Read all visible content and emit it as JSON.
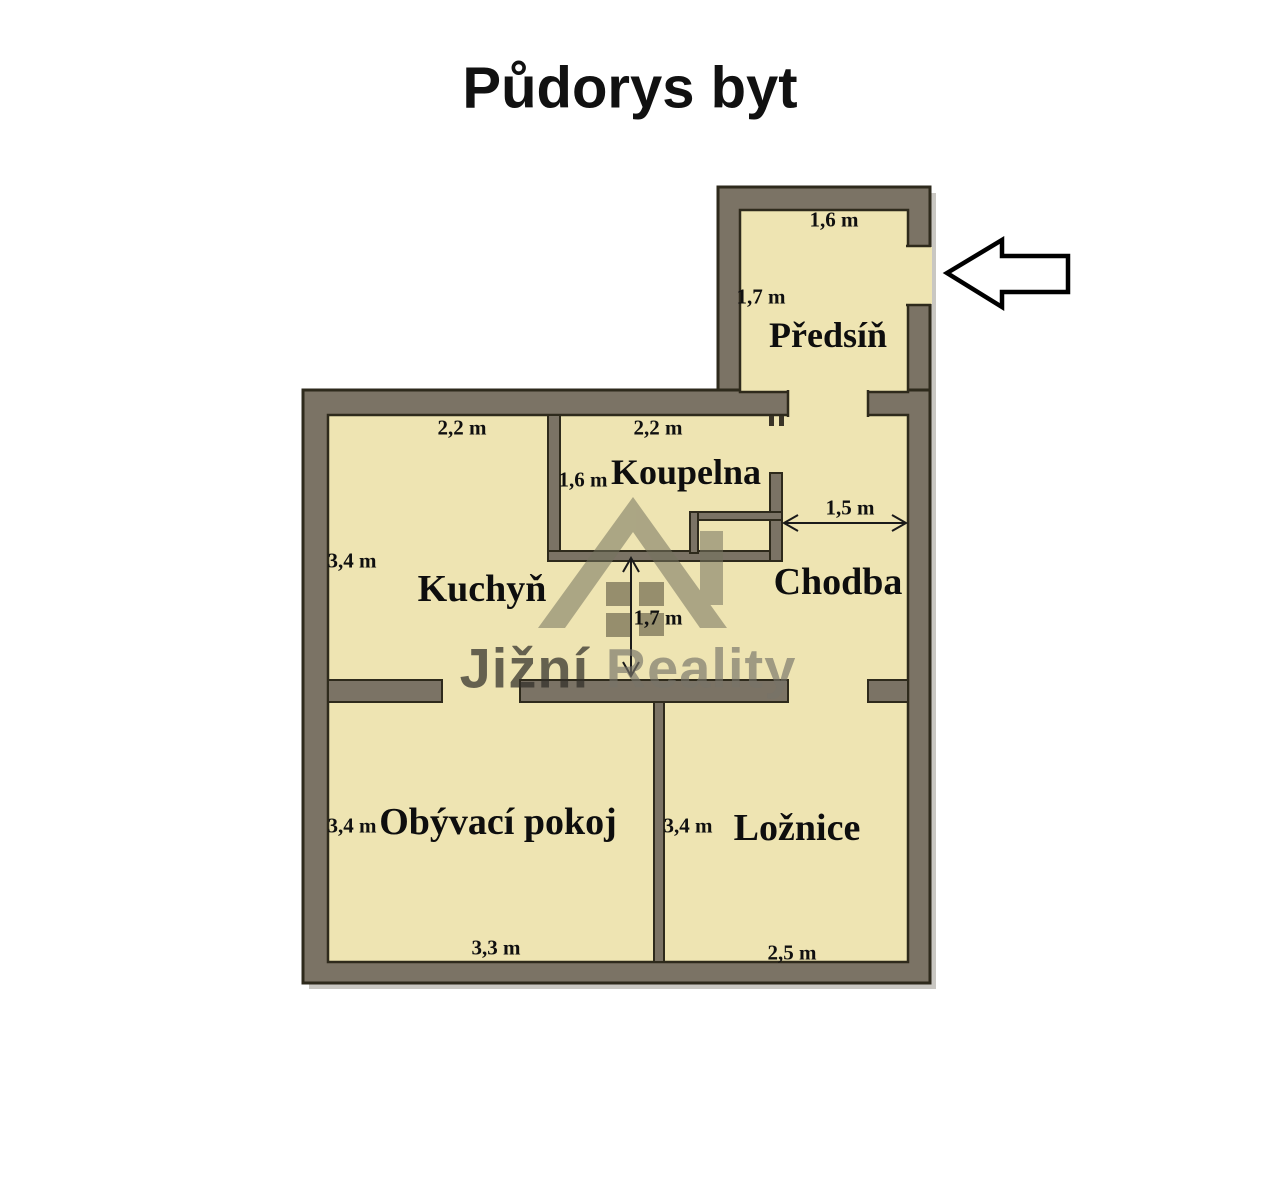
{
  "title": "Půdorys byt",
  "watermark": {
    "brand_part1": "Jižní",
    "brand_part2": "Reality",
    "icon": "house-roof-with-chimney-and-window"
  },
  "rooms": {
    "predsin": {
      "label": "Předsíň",
      "width": "1,6 m",
      "height": "1,7 m"
    },
    "koupelna": {
      "label": "Koupelna",
      "width": "2,2 m",
      "height": "1,6 m"
    },
    "kuchyn": {
      "label": "Kuchyň",
      "width": "2,2 m",
      "height": "3,4 m"
    },
    "chodba": {
      "label": "Chodba",
      "width": "1,5 m"
    },
    "passage": {
      "height": "1,7 m"
    },
    "obyvaci_pokoj": {
      "label": "Obývací pokoj",
      "width": "3,3 m",
      "height": "3,4 m"
    },
    "loznice": {
      "label": "Ložnice",
      "width": "2,5 m",
      "height": "3,4 m"
    }
  },
  "colors": {
    "background": "#FFFFFF",
    "floor": "#EEE4B2",
    "wall": "#7B7365",
    "outline": "#2E2A1C",
    "shadow": "#C9C7C2",
    "watermark_gray": "#A8A699",
    "entrance_arrow_fill": "#FFFFFF",
    "entrance_arrow_stroke": "#000000",
    "dimension_line": "#1A1A1A"
  }
}
